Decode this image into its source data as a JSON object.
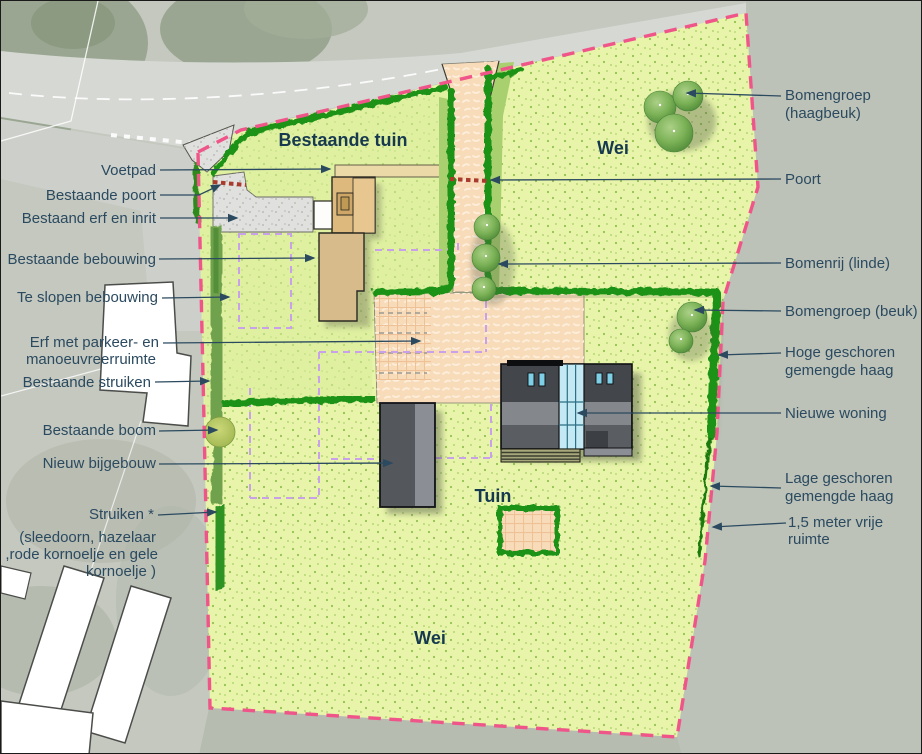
{
  "plan_type": "landscape-site-plan",
  "areas": {
    "bestaande_tuin": "Bestaande tuin",
    "wei_top": "Wei",
    "tuin": "Tuin",
    "wei_bottom": "Wei"
  },
  "left_labels": [
    {
      "id": "voetpad",
      "lines": [
        "Voetpad"
      ]
    },
    {
      "id": "bestaande-poort",
      "lines": [
        "Bestaande poort"
      ]
    },
    {
      "id": "bestaand-erf-en-inrit",
      "lines": [
        "Bestaand erf en inrit"
      ]
    },
    {
      "id": "bestaande-bebouwing",
      "lines": [
        "Bestaande bebouwing"
      ]
    },
    {
      "id": "te-slopen-bebouwing",
      "lines": [
        "Te slopen bebouwing"
      ]
    },
    {
      "id": "erf-met-parkeer",
      "lines": [
        "Erf met parkeer- en",
        "manoeuvreerruimte"
      ]
    },
    {
      "id": "bestaande-struiken",
      "lines": [
        "Bestaande struiken"
      ]
    },
    {
      "id": "bestaande-boom",
      "lines": [
        "Bestaande boom"
      ]
    },
    {
      "id": "nieuw-bijgebouw",
      "lines": [
        "Nieuw bijgebouw"
      ]
    },
    {
      "id": "struiken",
      "lines": [
        "Struiken *"
      ]
    },
    {
      "id": "struiken-soorten",
      "lines": [
        "(sleedoorn, hazelaar",
        ",rode kornoelje en gele",
        "kornoelje )"
      ]
    }
  ],
  "right_labels": [
    {
      "id": "bomengroep-haagbeuk",
      "lines": [
        "Bomengroep",
        "(haagbeuk)"
      ]
    },
    {
      "id": "poort",
      "lines": [
        "Poort"
      ]
    },
    {
      "id": "bomenrij-linde",
      "lines": [
        "Bomenrij (linde)"
      ]
    },
    {
      "id": "bomengroep-beuk",
      "lines": [
        "Bomengroep (beuk)"
      ]
    },
    {
      "id": "hoge-haag",
      "lines": [
        "Hoge geschoren",
        "gemengde haag"
      ]
    },
    {
      "id": "nieuwe-woning",
      "lines": [
        "Nieuwe woning"
      ]
    },
    {
      "id": "lage-haag",
      "lines": [
        "Lage geschoren",
        "gemengde haag"
      ]
    },
    {
      "id": "vrije-ruimte",
      "lines": [
        "1,5 meter vrije",
        "ruimte"
      ]
    }
  ],
  "colors": {
    "boundary_pink": "#f0558a",
    "hedge_green": "#1f9213",
    "shrub_green": "#6fa24d",
    "new_shrub_green": "#2e9320",
    "parcel_green": "#e7f4a9",
    "drive_peach": "#f8dcba",
    "purple_dashed": "#c9a1ea",
    "gate_red": "#a93a2c",
    "label_text": "#2b4a60",
    "area_label_text": "#16394f",
    "existing_building_tan": "#ddb97e",
    "new_building_grey": "#46494e",
    "glass_blue": "#c2e9f4"
  }
}
